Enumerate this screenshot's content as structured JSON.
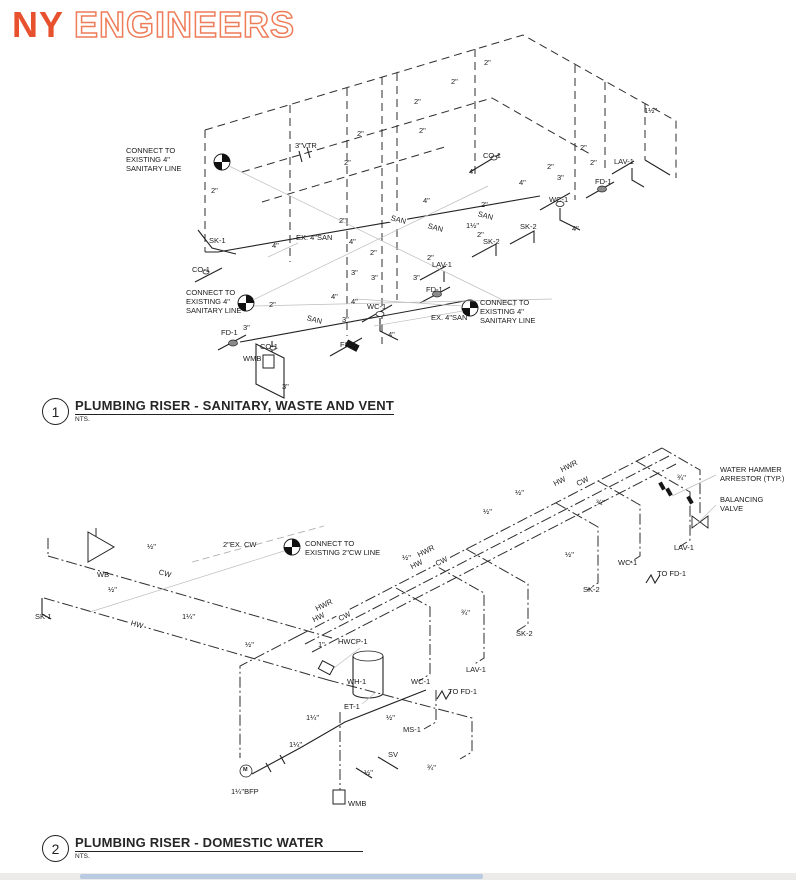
{
  "logo": {
    "part1": "NY",
    "part2": "ENGINEERS"
  },
  "colors": {
    "logo_solid": "#e8512e",
    "logo_outline": "#ee7c58",
    "line": "#2e2e2e",
    "leader": "#bdbdbd",
    "footer_bar": "#b9cbe2",
    "footer_bg": "#ecebe9"
  },
  "diagram1": {
    "number": "1",
    "title": "PLUMBING RISER - SANITARY, WASTE AND VENT",
    "scale": "NTS.",
    "labels": [
      {
        "t": "CONNECT TO\nEXISTING 4\"\nSANITARY LINE",
        "x": 126,
        "y": 146,
        "cls": "pre",
        "n": "note-connect-existing-sanitary-upper"
      },
      {
        "t": "3\"VTR",
        "x": 295,
        "y": 141,
        "n": "tag-vtr"
      },
      {
        "t": "2\"",
        "x": 211,
        "y": 186
      },
      {
        "t": "2\"",
        "x": 344,
        "y": 158
      },
      {
        "t": "2\"",
        "x": 339,
        "y": 216
      },
      {
        "t": "2\"",
        "x": 357,
        "y": 129
      },
      {
        "t": "2\"",
        "x": 414,
        "y": 97
      },
      {
        "t": "2\"",
        "x": 451,
        "y": 77
      },
      {
        "t": "2\"",
        "x": 484,
        "y": 58
      },
      {
        "t": "2\"",
        "x": 419,
        "y": 126
      },
      {
        "t": "2\"",
        "x": 547,
        "y": 162
      },
      {
        "t": "2\"",
        "x": 580,
        "y": 143
      },
      {
        "t": "2\"",
        "x": 590,
        "y": 158
      },
      {
        "t": "1½\"",
        "x": 644,
        "y": 106
      },
      {
        "t": "LAV-1",
        "x": 614,
        "y": 157,
        "n": "tag-lav-1"
      },
      {
        "t": "FD-1",
        "x": 595,
        "y": 177,
        "n": "tag-fd-1"
      },
      {
        "t": "WC-1",
        "x": 549,
        "y": 195,
        "n": "tag-wc-1"
      },
      {
        "t": "3\"",
        "x": 557,
        "y": 173
      },
      {
        "t": "4\"",
        "x": 519,
        "y": 178
      },
      {
        "t": "SK-2",
        "x": 520,
        "y": 222,
        "n": "tag-sk-2"
      },
      {
        "t": "SK-2",
        "x": 483,
        "y": 237,
        "n": "tag-sk-2"
      },
      {
        "t": "4\"",
        "x": 572,
        "y": 224
      },
      {
        "t": "CO-1",
        "x": 483,
        "y": 151,
        "n": "tag-co-1"
      },
      {
        "t": "4\"",
        "x": 469,
        "y": 167
      },
      {
        "t": "4\"",
        "x": 423,
        "y": 196
      },
      {
        "t": "2\"",
        "x": 481,
        "y": 200
      },
      {
        "t": "SAN",
        "x": 390,
        "y": 213,
        "r": 14,
        "cls": "inl"
      },
      {
        "t": "SAN",
        "x": 427,
        "y": 221,
        "r": 14,
        "cls": "inl"
      },
      {
        "t": "SAN",
        "x": 477,
        "y": 209,
        "r": 14,
        "cls": "inl"
      },
      {
        "t": "1½\"",
        "x": 466,
        "y": 221
      },
      {
        "t": "2\"",
        "x": 477,
        "y": 230
      },
      {
        "t": "SK-1",
        "x": 209,
        "y": 236,
        "n": "tag-sk-1"
      },
      {
        "t": "CO-1",
        "x": 192,
        "y": 265,
        "n": "tag-co-1"
      },
      {
        "t": "EX. 4\"SAN",
        "x": 296,
        "y": 233,
        "n": "tag-ex-san"
      },
      {
        "t": "4\"",
        "x": 272,
        "y": 241
      },
      {
        "t": "4\"",
        "x": 349,
        "y": 237
      },
      {
        "t": "2\"",
        "x": 370,
        "y": 248
      },
      {
        "t": "CONNECT TO\nEXISTING 4\"\nSANITARY LINE",
        "x": 186,
        "y": 288,
        "cls": "pre",
        "n": "note-connect-existing-sanitary-lower"
      },
      {
        "t": "2\"",
        "x": 269,
        "y": 300
      },
      {
        "t": "3\"",
        "x": 351,
        "y": 268
      },
      {
        "t": "3\"",
        "x": 371,
        "y": 273
      },
      {
        "t": "3\"",
        "x": 413,
        "y": 273
      },
      {
        "t": "SAN",
        "x": 306,
        "y": 313,
        "r": 14,
        "cls": "inl"
      },
      {
        "t": "4\"",
        "x": 331,
        "y": 292
      },
      {
        "t": "4\"",
        "x": 351,
        "y": 297
      },
      {
        "t": "WC-1",
        "x": 367,
        "y": 302,
        "n": "tag-wc-1"
      },
      {
        "t": "3\"",
        "x": 342,
        "y": 315
      },
      {
        "t": "FD-1",
        "x": 221,
        "y": 328,
        "n": "tag-fd-1"
      },
      {
        "t": "3\"",
        "x": 243,
        "y": 323
      },
      {
        "t": "CO-1",
        "x": 260,
        "y": 342,
        "n": "tag-co-1"
      },
      {
        "t": "FS-1",
        "x": 340,
        "y": 340,
        "n": "tag-fs-1"
      },
      {
        "t": "WMB",
        "x": 243,
        "y": 354,
        "n": "tag-wmb"
      },
      {
        "t": "4\"",
        "x": 388,
        "y": 330
      },
      {
        "t": "EX. 4\"SAN",
        "x": 431,
        "y": 313,
        "n": "tag-ex-san"
      },
      {
        "t": "CONNECT TO\nEXISTING 4\"\nSANITARY LINE",
        "x": 480,
        "y": 298,
        "cls": "pre",
        "n": "note-connect-existing-sanitary-right"
      },
      {
        "t": "LAV-1",
        "x": 432,
        "y": 260,
        "n": "tag-lav-1"
      },
      {
        "t": "2\"",
        "x": 427,
        "y": 253
      },
      {
        "t": "FD-1",
        "x": 426,
        "y": 285,
        "n": "tag-fd-1"
      },
      {
        "t": "3\"",
        "x": 282,
        "y": 382
      }
    ]
  },
  "diagram2": {
    "number": "2",
    "title": "PLUMBING RISER - DOMESTIC WATER",
    "scale": "NTS.",
    "labels": [
      {
        "t": "WATER HAMMER\nARRESTOR (TYP.)",
        "x": 720,
        "y": 465,
        "cls": "pre",
        "n": "note-water-hammer-arrestor"
      },
      {
        "t": "BALANCING\nVALVE",
        "x": 720,
        "y": 495,
        "cls": "pre",
        "n": "note-balancing-valve"
      },
      {
        "t": "¾\"",
        "x": 677,
        "y": 473
      },
      {
        "t": "¾\"",
        "x": 596,
        "y": 498
      },
      {
        "t": "LAV-1",
        "x": 674,
        "y": 543,
        "n": "tag-lav-1"
      },
      {
        "t": "WC-1",
        "x": 618,
        "y": 558,
        "n": "tag-wc-1"
      },
      {
        "t": "TO FD-1",
        "x": 657,
        "y": 569,
        "n": "tag-to-fd-1"
      },
      {
        "t": "SK-2",
        "x": 583,
        "y": 585,
        "n": "tag-sk-2"
      },
      {
        "t": "½\"",
        "x": 565,
        "y": 550
      },
      {
        "t": "HWR",
        "x": 560,
        "y": 466,
        "r": -27,
        "cls": "inl"
      },
      {
        "t": "HW",
        "x": 553,
        "y": 480,
        "r": -27,
        "cls": "inl"
      },
      {
        "t": "CW",
        "x": 576,
        "y": 480,
        "r": -27,
        "cls": "inl"
      },
      {
        "t": "½\"",
        "x": 515,
        "y": 488
      },
      {
        "t": "½\"",
        "x": 483,
        "y": 507
      },
      {
        "t": "½\"",
        "x": 402,
        "y": 553
      },
      {
        "t": "HWR",
        "x": 417,
        "y": 551,
        "r": -27,
        "cls": "inl"
      },
      {
        "t": "HW",
        "x": 410,
        "y": 563,
        "r": -27,
        "cls": "inl"
      },
      {
        "t": "CW",
        "x": 435,
        "y": 560,
        "r": -27,
        "cls": "inl"
      },
      {
        "t": "CONNECT TO\nEXISTING 2\"CW LINE",
        "x": 305,
        "y": 539,
        "cls": "pre",
        "n": "note-connect-existing-cw"
      },
      {
        "t": "2\"EX. CW",
        "x": 223,
        "y": 540,
        "n": "tag-ex-cw"
      },
      {
        "t": "½\"",
        "x": 147,
        "y": 542
      },
      {
        "t": "WB",
        "x": 97,
        "y": 570,
        "n": "tag-wb"
      },
      {
        "t": "CW",
        "x": 158,
        "y": 567,
        "r": 16,
        "cls": "inl"
      },
      {
        "t": "½\"",
        "x": 108,
        "y": 585
      },
      {
        "t": "SK-1",
        "x": 35,
        "y": 612,
        "n": "tag-sk-1"
      },
      {
        "t": "HW",
        "x": 130,
        "y": 618,
        "r": 16,
        "cls": "inl"
      },
      {
        "t": "1¼\"",
        "x": 182,
        "y": 612
      },
      {
        "t": "HWR",
        "x": 315,
        "y": 605,
        "r": -27,
        "cls": "inl"
      },
      {
        "t": "HW",
        "x": 312,
        "y": 616,
        "r": -27,
        "cls": "inl"
      },
      {
        "t": "CW",
        "x": 338,
        "y": 615,
        "r": -27,
        "cls": "inl"
      },
      {
        "t": "½\"",
        "x": 245,
        "y": 640
      },
      {
        "t": "¾\"",
        "x": 461,
        "y": 608
      },
      {
        "t": "SK-2",
        "x": 516,
        "y": 629,
        "n": "tag-sk-2"
      },
      {
        "t": "1\"",
        "x": 318,
        "y": 640
      },
      {
        "t": "HWCP-1",
        "x": 338,
        "y": 637,
        "n": "tag-hwcp-1"
      },
      {
        "t": "WH-1",
        "x": 347,
        "y": 677,
        "n": "tag-wh-1"
      },
      {
        "t": "ET-1",
        "x": 344,
        "y": 702,
        "n": "tag-et-1"
      },
      {
        "t": "WC-1",
        "x": 411,
        "y": 677,
        "n": "tag-wc-1"
      },
      {
        "t": "TO FD-1",
        "x": 448,
        "y": 687,
        "n": "tag-to-fd-1"
      },
      {
        "t": "LAV-1",
        "x": 466,
        "y": 665,
        "n": "tag-lav-1"
      },
      {
        "t": "MS-1",
        "x": 403,
        "y": 725,
        "n": "tag-ms-1"
      },
      {
        "t": "1¼\"",
        "x": 306,
        "y": 713
      },
      {
        "t": "½\"",
        "x": 386,
        "y": 713
      },
      {
        "t": "1¼\"",
        "x": 289,
        "y": 740
      },
      {
        "t": "SV",
        "x": 388,
        "y": 750,
        "n": "tag-sv"
      },
      {
        "t": "¾\"",
        "x": 427,
        "y": 763
      },
      {
        "t": "½\"",
        "x": 364,
        "y": 768
      },
      {
        "t": "M",
        "x": 243,
        "y": 767,
        "cls": "sym",
        "n": "bfp-meter-m"
      },
      {
        "t": "1¼\"BFP",
        "x": 231,
        "y": 787,
        "n": "tag-bfp"
      },
      {
        "t": "WMB",
        "x": 348,
        "y": 799,
        "n": "tag-wmb"
      }
    ]
  }
}
